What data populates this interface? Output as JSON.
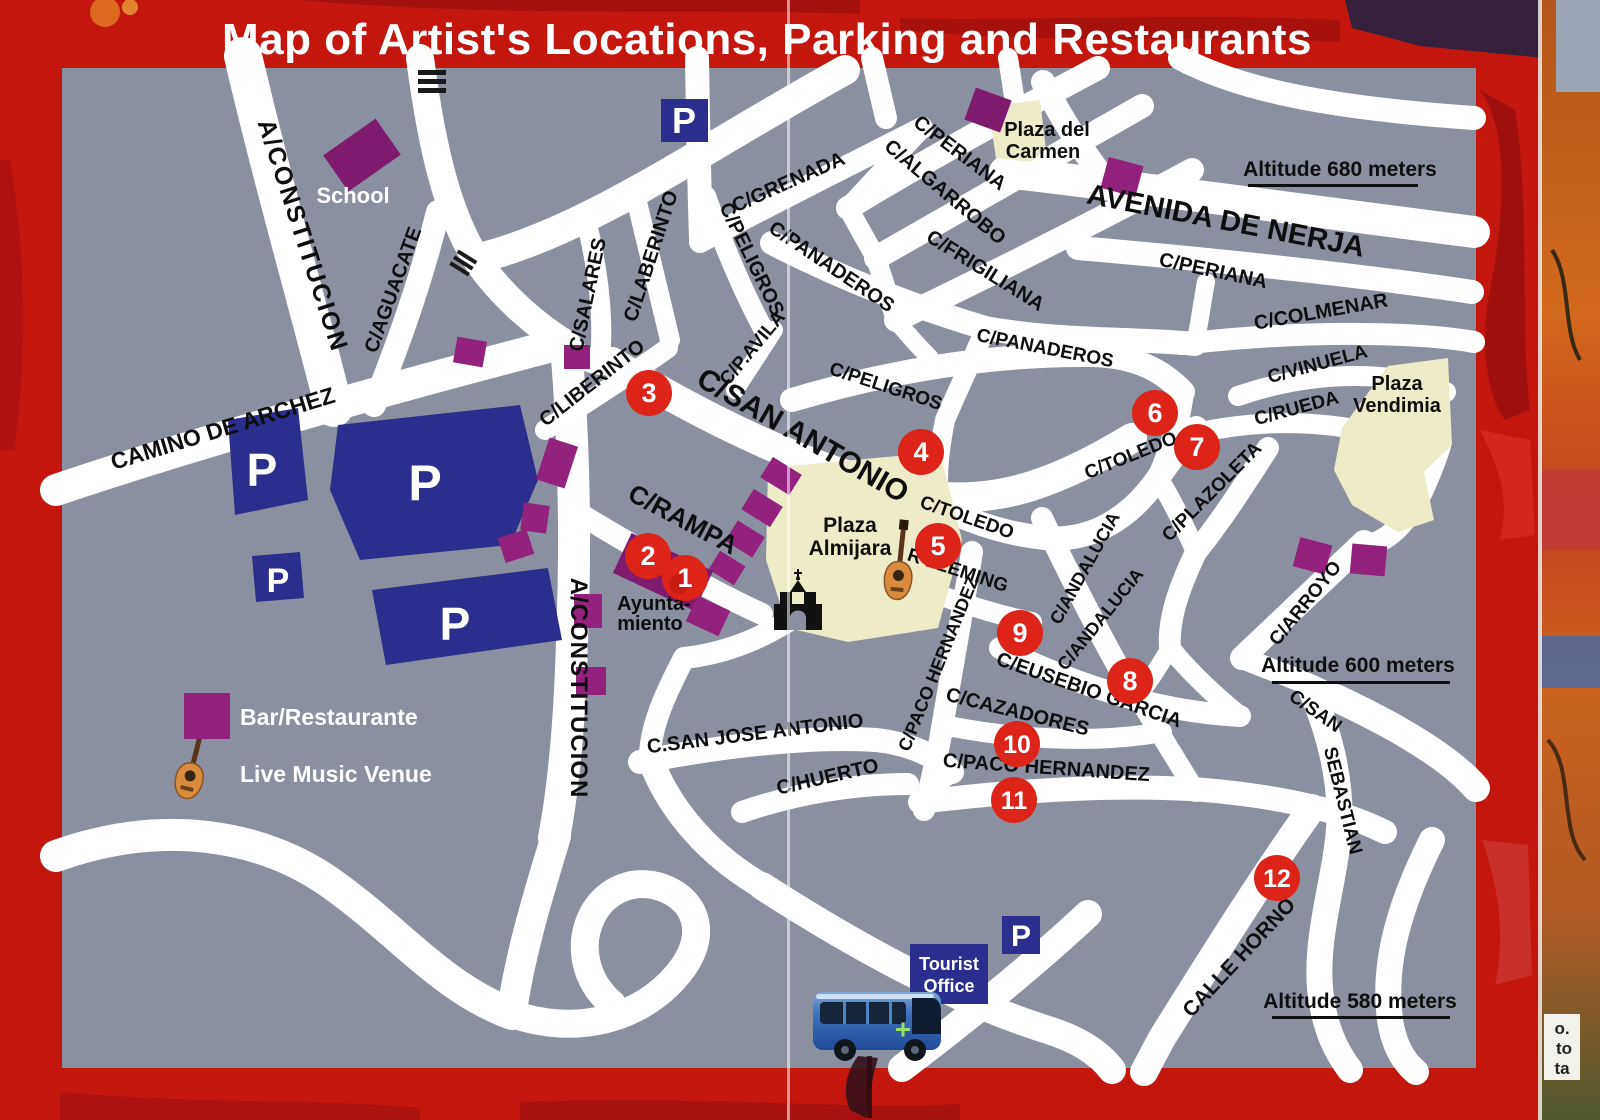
{
  "title": "Map of Artist's Locations, Parking and Restaurants",
  "legend": {
    "bar_restaurante": "Bar/Restaurante",
    "live_music_venue": "Live Music Venue"
  },
  "altitude": {
    "a680": "Altitude 680 meters",
    "a600": "Altitude 600 meters",
    "a580": "Altitude 580 meters"
  },
  "places": {
    "school": "School",
    "plaza_del_carmen": [
      "Plaza del",
      "Carmen"
    ],
    "plaza_almijara": [
      "Plaza",
      "Almijara"
    ],
    "plaza_vendimia": [
      "Plaza",
      "Vendimia"
    ],
    "ayuntamiento": [
      "Ayunta-",
      "miento"
    ],
    "tourist_office": [
      "Tourist",
      "Office"
    ]
  },
  "parking_letter": "P",
  "streets": {
    "a_constitucion_1": "A/CONSTITUCION",
    "camino_de_archez": "CAMINO DE ARCHEZ",
    "c_aguacate": "C/AGUACATE",
    "c_salares": "C/SALARES",
    "c_laberinto": "C/LABERINTO",
    "c_liberinto": "C/LIBERINTO",
    "c_peligros_1": "C/PELIGROS",
    "c_grenada": "C/GRENADA",
    "c_panaderos_1": "C/PANADEROS",
    "c_p_avila": "C/P.AVILA",
    "c_periana_1": "C/PERIANA",
    "c_algarrobo": "C/ALGARROBO",
    "c_frigiliana": "C/FRIGILIANA",
    "avenida_de_nerja": "AVENIDA DE NERJA",
    "c_periana_2": "C/PERIANA",
    "c_colmenar": "C/COLMENAR",
    "c_vinuela": "C/VINUELA",
    "c_rueda": "C/RUEDA",
    "c_san_antonio": "C/SAN ANTONIO",
    "c_peligros_2": "C/PELIGROS",
    "c_panaderos_2": "C/PANADEROS",
    "c_rampa": "C/RAMPA",
    "c_toledo_1": "C/TOLEDO",
    "c_toledo_2": "C/TOLEDO",
    "c_plazoleta": "C/PLAZOLETA",
    "c_andalucia_1": "C/ANDALUCIA",
    "c_andalucia_2": "C/ANDALUCIA",
    "r_fleming": "R FLEMING",
    "c_paco_hernandez_v": "C/PACO HERNANDEZ",
    "c_eusebio_garcia": "C/EUSEBIO GARCIA",
    "c_cazadores": "C/CAZADORES",
    "c_paco_hernandez_h": "C/PACO HERNANDEZ",
    "c_san_jose_antonio": "C.SAN JOSE ANTONIO",
    "c_huerto": "C/HUERTO",
    "a_constitucion_2": "A/CONSTITUCION",
    "c_arroyo": "C/ARROYO",
    "c_san": "C/SAN",
    "sebastian": "SEBASTIAN",
    "calle_horno": "CALLE HORNO"
  },
  "markers": [
    "1",
    "2",
    "3",
    "4",
    "5",
    "6",
    "7",
    "8",
    "9",
    "10",
    "11",
    "12"
  ],
  "photo_edge_fragment": [
    "o.",
    "to",
    "ta"
  ],
  "colors": {
    "border_red": "#c3170e",
    "map_gray": "#8b90a0",
    "street_white": "#ffffff",
    "marker_red": "#dc2418",
    "bar_purple": "#93217e",
    "parking_navy": "#2b2e8c",
    "plaza_cream": "#eeebc9"
  }
}
